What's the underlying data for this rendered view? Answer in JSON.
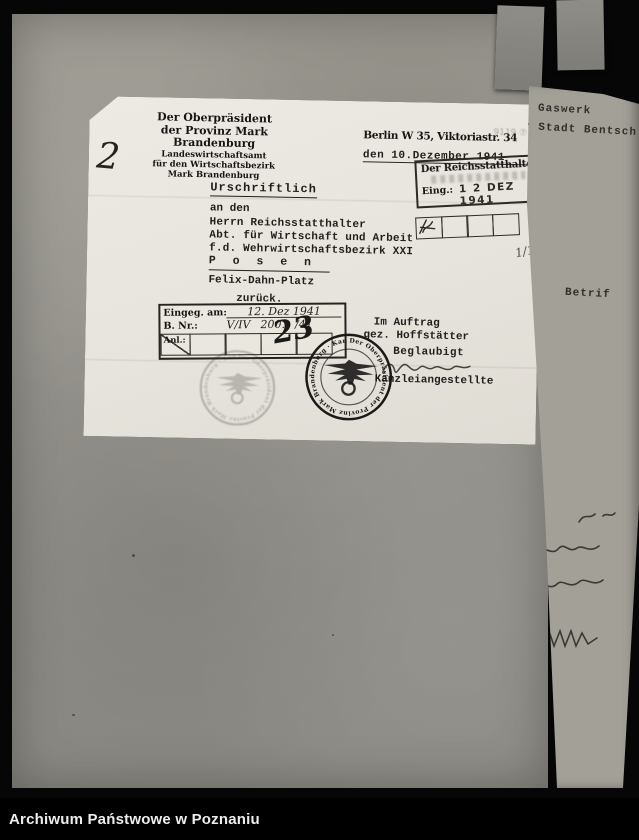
{
  "colors": {
    "frame_background": "#060606",
    "verso_page_gray": "#96948e",
    "letter_paper": "#eae8e1",
    "ink": "#201f1c",
    "caption_text": "#ededed"
  },
  "frame": {
    "caption": "Archiwum Państwowe w Poznaniu"
  },
  "letter": {
    "margin_number": "2",
    "letterhead": [
      "Der Oberpräsident",
      "der Provinz Mark Brandenburg",
      "Landeswirtschaftsamt",
      "für den Wirtschaftsbezirk",
      "Mark Brandenburg"
    ],
    "dateline": {
      "place": "Berlin W 35, Viktoriastr. 34",
      "date": "den 10.Dezember 1941",
      "bleedthrough": "9119 ⑦"
    },
    "arrival_stamp": {
      "title": "Der Reichsstatthalter",
      "eing_label": "Eing.:",
      "eing_date": "1 2 DEZ 1941",
      "margin_note": "1/1"
    },
    "body": {
      "urschriftlich": "Urschriftlich",
      "salutation": "an den",
      "addressee": "Herrn Reichsstatthalter",
      "dept": "Abt. für Wirtschaft und Arbeit",
      "district": "f.d. Wehrwirtschaftsbezirk XXI",
      "city": "P o s e n",
      "street": "Felix-Dahn-Platz",
      "note": "zurück."
    },
    "entry_stamp": {
      "row1_label": "Eingeg. am:",
      "row1_value": "12. Dez 1941",
      "row2_label": "B. Nr.:",
      "row2_value_a": "V/IV",
      "row2_value_b": "200.",
      "row2_value_c": "/41",
      "row3_label": "Anl.:",
      "handwritten_number": "23"
    },
    "signature_block": {
      "line1": "Im Auftrag",
      "line2": "gez. Hoffstätter",
      "line3": "Beglaubigt",
      "line4": "Kanzleiangestellte"
    },
    "round_stamp": {
      "ring_text": "Der Oberpräsident der Provinz Mark Brandenburg · Kanzlei ·"
    }
  },
  "adjacent_page": {
    "line1": "Gaswerk",
    "line2": "r Stadt Bentsch",
    "line3": "Betrif"
  }
}
